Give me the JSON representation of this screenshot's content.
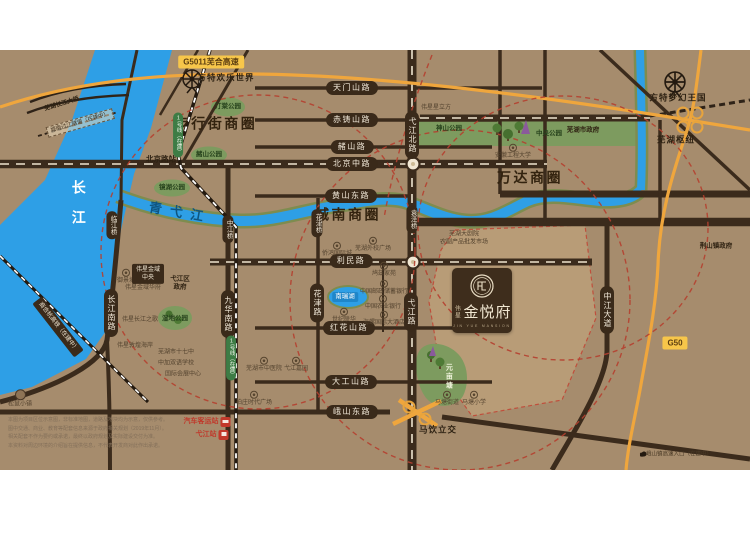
{
  "map": {
    "colors": {
      "background": "#a68c6d",
      "road": "#3b2b1c",
      "river": "#2e9fe6",
      "river_bank": "#7e8c4f",
      "park": "#7d9b5f",
      "highway": "#efa63d",
      "highway_badge": "#f7c64a",
      "ring_red": "#b5402f",
      "road_badge": "#3a2a1a",
      "metro_badge": "#3d7c45",
      "logo_panel": "#3e2d1c",
      "plot": "#b89c77"
    },
    "logo": {
      "brand": "伟星",
      "name": "金悦府",
      "sub": "JIN YUE MANSION"
    },
    "labels": [
      {
        "name": "district-pedestrian-street",
        "type": "dist",
        "text": "步行街商圈",
        "x": 216,
        "y": 74
      },
      {
        "name": "district-chengnan",
        "type": "dist",
        "text": "城南商圈",
        "x": 348,
        "y": 165
      },
      {
        "name": "district-wanda",
        "type": "dist",
        "text": "万达商圈",
        "x": 530,
        "y": 128
      },
      {
        "name": "road-badge-tianmenshan",
        "type": "hb",
        "text": "天门山路",
        "x": 352,
        "y": 38
      },
      {
        "name": "road-badge-chizhushan",
        "type": "hb",
        "text": "赤铸山路",
        "x": 352,
        "y": 70
      },
      {
        "name": "road-badge-zheshan",
        "type": "hb",
        "text": "赭山路",
        "x": 352,
        "y": 97
      },
      {
        "name": "road-badge-beijingzhong",
        "type": "hb",
        "text": "北京中路",
        "x": 352,
        "y": 114
      },
      {
        "name": "road-badge-huangshandong",
        "type": "hb",
        "text": "黄山东路",
        "x": 351,
        "y": 146
      },
      {
        "name": "road-badge-limin",
        "type": "hb",
        "text": "利民路",
        "x": 351,
        "y": 211
      },
      {
        "name": "road-badge-honghuashan",
        "type": "hb",
        "text": "红花山路",
        "x": 349,
        "y": 278
      },
      {
        "name": "road-badge-dagongshan",
        "type": "hb",
        "text": "大工山路",
        "x": 351,
        "y": 332
      },
      {
        "name": "road-badge-eshandong",
        "type": "hb",
        "text": "峨山东路",
        "x": 352,
        "y": 362
      },
      {
        "name": "road-badge-yijiangbei",
        "type": "vb",
        "text": "弋江北路",
        "x": 412,
        "y": 85
      },
      {
        "name": "road-badge-yijiang",
        "type": "vb",
        "text": "弋江路",
        "x": 411,
        "y": 262
      },
      {
        "name": "road-badge-jiuhuanan",
        "type": "vb",
        "text": "九华南路",
        "x": 228,
        "y": 264
      },
      {
        "name": "road-badge-huajin",
        "type": "vb",
        "text": "花津路",
        "x": 317,
        "y": 253
      },
      {
        "name": "road-badge-changjiangnan",
        "type": "vb",
        "text": "长江南路",
        "x": 111,
        "y": 263
      },
      {
        "name": "road-badge-zhongjiang",
        "type": "vb",
        "text": "中江大道",
        "x": 607,
        "y": 260
      },
      {
        "name": "bridge-badge-linjiang",
        "type": "vbs",
        "text": "临江桥",
        "x": 112,
        "y": 175
      },
      {
        "name": "bridge-badge-zhongjiang",
        "type": "vbs",
        "text": "中江桥",
        "x": 228,
        "y": 179
      },
      {
        "name": "bridge-badge-huajin",
        "type": "vbs",
        "text": "花津桥",
        "x": 317,
        "y": 173
      },
      {
        "name": "bridge-badge-yuanze",
        "type": "vbs",
        "text": "袁泽桥",
        "x": 412,
        "y": 169
      },
      {
        "name": "metro-badge-line1-north",
        "type": "mb",
        "text": "1号线（在建）",
        "x": 178,
        "y": 85
      },
      {
        "name": "metro-badge-line1-south",
        "type": "mb",
        "text": "1号线（在建）",
        "x": 231,
        "y": 308
      },
      {
        "name": "highway-badge-g5011",
        "type": "yb",
        "text": "G5011芜合高速",
        "x": 211,
        "y": 12
      },
      {
        "name": "highway-badge-g50",
        "type": "yb",
        "text": "G50",
        "x": 675,
        "y": 293
      },
      {
        "name": "park-tingtang",
        "type": "park",
        "text": "汀棠公园",
        "x": 228,
        "y": 57
      },
      {
        "name": "park-zheshan",
        "type": "park",
        "text": "赭山公园",
        "x": 209,
        "y": 105
      },
      {
        "name": "park-jinghu",
        "type": "park",
        "text": "镜湖公园",
        "x": 172,
        "y": 138
      },
      {
        "name": "park-shenshan",
        "type": "park",
        "text": "神山公园",
        "x": 449,
        "y": 79
      },
      {
        "name": "park-zhongyang",
        "type": "park",
        "text": "中央公园",
        "x": 549,
        "y": 84
      },
      {
        "name": "park-shidi",
        "type": "park",
        "text": "湿地公园",
        "x": 175,
        "y": 269
      },
      {
        "name": "park-yuanmutang",
        "type": "parkv",
        "text": "元亩塘",
        "x": 448,
        "y": 327
      },
      {
        "name": "poi-wuhu-government",
        "type": "poib",
        "text": "芜湖市政府",
        "x": 583,
        "y": 80,
        "icon": "star-icon"
      },
      {
        "name": "poi-jingshan-government",
        "type": "poib",
        "text": "荆山镇政府",
        "x": 716,
        "y": 196,
        "icon": "star-icon"
      },
      {
        "name": "poi-yijiang-government",
        "type": "poib",
        "text": "弋江区\n政府",
        "x": 180,
        "y": 233,
        "icon": "star-icon"
      },
      {
        "name": "poi-weixing-xinglifang",
        "type": "poi",
        "text": "伟星星立方",
        "x": 436,
        "y": 58,
        "icon": "star-icon"
      },
      {
        "name": "poi-weixing-jinyu-huafu",
        "type": "poi",
        "text": "伟星金域华府",
        "x": 143,
        "y": 238,
        "icon": "star-icon"
      },
      {
        "name": "poi-weixing-changjiangzhige",
        "type": "poi",
        "text": "伟星长江之歌",
        "x": 140,
        "y": 270,
        "icon": "star-icon"
      },
      {
        "name": "poi-weixing-dunhuanghaian",
        "type": "poi",
        "text": "伟星敦煌海岸",
        "x": 135,
        "y": 296,
        "icon": "star-icon"
      },
      {
        "name": "label-wuhu-hub",
        "type": "hub",
        "text": "芜湖枢纽",
        "x": 676,
        "y": 90
      },
      {
        "name": "label-mayin-interchange",
        "type": "hub",
        "text": "马饮立交",
        "x": 438,
        "y": 380
      },
      {
        "name": "label-beijinglu-station",
        "type": "station",
        "text": "北京路站",
        "x": 161,
        "y": 109
      },
      {
        "name": "label-fantawild-joyland",
        "type": "hub",
        "text": "方特欢乐世界",
        "x": 226,
        "y": 28
      },
      {
        "name": "label-fantawild-dreamkingdom",
        "type": "hub",
        "text": "方特梦幻王国",
        "x": 678,
        "y": 48
      },
      {
        "name": "poi-anhui-polytechnic",
        "type": "poi",
        "text": "安徽工程大学",
        "x": 513,
        "y": 102,
        "icon": "circle-icon"
      },
      {
        "name": "poi-yujingcheng",
        "type": "poi",
        "text": "御景城",
        "x": 126,
        "y": 227,
        "icon": "circle-icon"
      },
      {
        "name": "poi-weixing-jinyu-center",
        "type": "boxdk",
        "text": "伟星金域\n中央",
        "x": 148,
        "y": 224
      },
      {
        "name": "poi-qiaohong-international",
        "type": "poi",
        "text": "侨鸿国际城",
        "x": 337,
        "y": 200,
        "icon": "circle-icon"
      },
      {
        "name": "poi-waixiao-plaza",
        "type": "poi",
        "text": "芜湖外校广场",
        "x": 373,
        "y": 195,
        "icon": "circle-icon"
      },
      {
        "name": "poi-grand-theatre",
        "type": "poi",
        "text": "芜湖大剧院\n农副产品批发市场",
        "x": 464,
        "y": 189
      },
      {
        "name": "poi-jiuzi-jiayuan",
        "type": "poi",
        "text": "鸠兹家苑",
        "x": 384,
        "y": 220,
        "icon": "circle-icon"
      },
      {
        "name": "poi-postal-bank",
        "type": "poi",
        "text": "中国邮政储蓄银行",
        "x": 384,
        "y": 238,
        "icon": "circle-icon"
      },
      {
        "name": "poi-agri-bank",
        "type": "poi",
        "text": "中国农业银行",
        "x": 383,
        "y": 253,
        "icon": "circle-icon"
      },
      {
        "name": "poi-conch-hotel",
        "type": "poi",
        "text": "海螺国际大酒店",
        "x": 384,
        "y": 269,
        "icon": "circle-icon"
      },
      {
        "name": "poi-shiji-lianhua",
        "type": "poi",
        "text": "世纪联华",
        "x": 344,
        "y": 266,
        "icon": "circle-icon"
      },
      {
        "name": "poi-no17-middle-school",
        "type": "poi",
        "text": "芜湖市十七中",
        "x": 176,
        "y": 303
      },
      {
        "name": "poi-sino-canada-school",
        "type": "poi",
        "text": "中加双语学校",
        "x": 176,
        "y": 314
      },
      {
        "name": "poi-convention-center",
        "type": "poi",
        "text": "国际会展中心",
        "x": 183,
        "y": 325
      },
      {
        "name": "poi-tcm-hospital",
        "type": "poi",
        "text": "芜湖市中医院",
        "x": 264,
        "y": 315,
        "icon": "circle-icon"
      },
      {
        "name": "poi-yijiang-jiayuan",
        "type": "poi",
        "text": "弋江嘉园",
        "x": 296,
        "y": 315,
        "icon": "circle-icon"
      },
      {
        "name": "poi-baizhuang-plaza",
        "type": "poi",
        "text": "柏庄时代广场",
        "x": 254,
        "y": 349,
        "icon": "circle-icon"
      },
      {
        "name": "poi-songshu-town",
        "type": "poi",
        "text": "松鼠小镇",
        "x": 20,
        "y": 349,
        "icon": "town-icon"
      },
      {
        "name": "poi-matang-jiedao",
        "type": "poi",
        "text": "马塘街道",
        "x": 447,
        "y": 349,
        "icon": "circle-icon"
      },
      {
        "name": "poi-matang-school",
        "type": "poi",
        "text": "马塘小学",
        "x": 474,
        "y": 349,
        "icon": "circle-icon"
      },
      {
        "name": "label-eshan-highway-entry",
        "type": "tiny",
        "text": "峨山镇高速入口（在建中）",
        "x": 676,
        "y": 405,
        "icon": "dot-icon",
        "iconside": "left"
      },
      {
        "name": "poi-bus-terminal",
        "type": "red",
        "text": "汽车客运站",
        "x": 207,
        "y": 372,
        "icon": "bus-icon",
        "iconside": "right"
      },
      {
        "name": "poi-yijiang-rail-station",
        "type": "red",
        "text": "弋江站",
        "x": 212,
        "y": 385,
        "icon": "train-icon",
        "iconside": "right"
      },
      {
        "name": "label-changjiang-river",
        "type": "riverv",
        "text": "长江",
        "x": 78,
        "y": 158
      },
      {
        "name": "label-qingyijiang-river",
        "type": "riverd",
        "text": "青弋江",
        "x": 180,
        "y": 163,
        "rot": 10
      },
      {
        "name": "label-nanruihu-lake",
        "type": "lake",
        "text": "南瑞湖",
        "x": 345,
        "y": 247
      },
      {
        "name": "label-changjiang-bridge",
        "type": "brl",
        "text": "芜湖长江大桥",
        "x": 62,
        "y": 55,
        "rot": -17
      },
      {
        "name": "label-chengnan-tunnel",
        "type": "boxdash",
        "text": "城南过江隧道（在建中）",
        "x": 80,
        "y": 73,
        "rot": -16
      },
      {
        "name": "label-shanghehang-railway",
        "type": "boxdk",
        "text": "商合杭高铁（在建中）",
        "x": 58,
        "y": 277,
        "rot": 52
      }
    ],
    "disclaimer": [
      "本图为项目区位示意图，非标准地图，道路及地块均为示意，仅供参考。",
      "图中交通、商业、教育等配套信息来源于政府相关规划（2019年11月）。",
      "相关配套不作为要约或承诺，最终以政府规划及实际建设交付为准。",
      "本资料对周边环境的介绍旨在提供信息，不代表开发商对此作出承诺。"
    ]
  }
}
